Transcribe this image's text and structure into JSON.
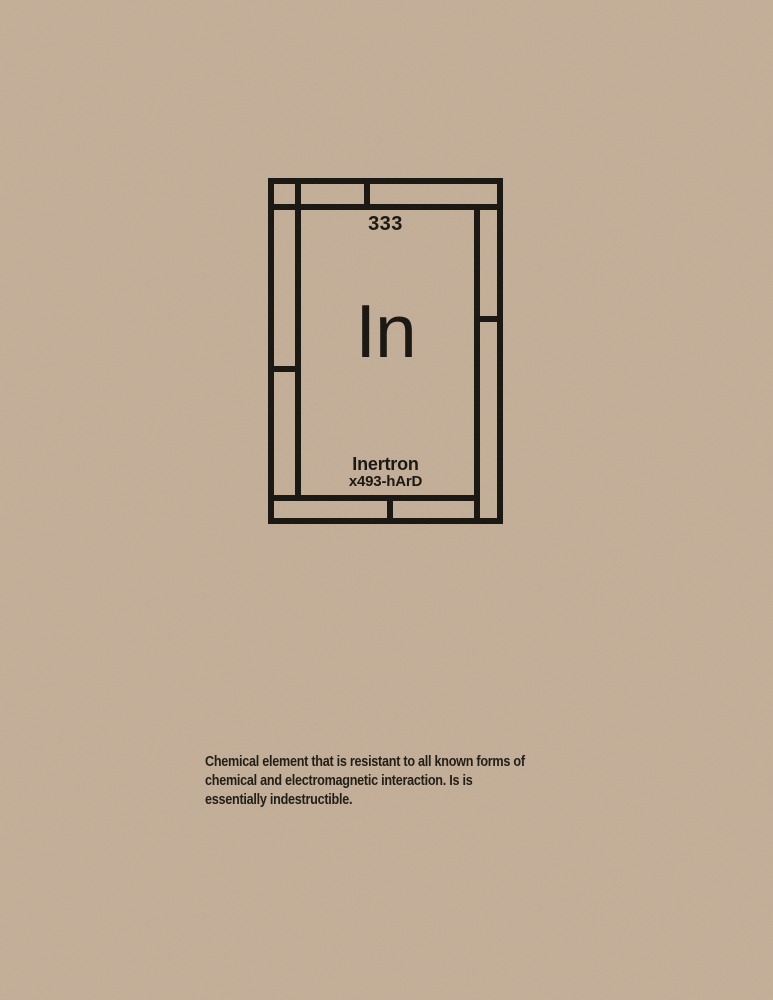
{
  "colors": {
    "background": "#c3ae97",
    "ink": "#16130e"
  },
  "element_card": {
    "atomic_number": "333",
    "symbol": "In",
    "name": "Inertron",
    "designation": "x493-hArD"
  },
  "description": {
    "lines": [
      "Chemical element that is resistant to all known forms of",
      "chemical and electromagnetic interaction. Is is",
      "essentially indestructible."
    ]
  }
}
